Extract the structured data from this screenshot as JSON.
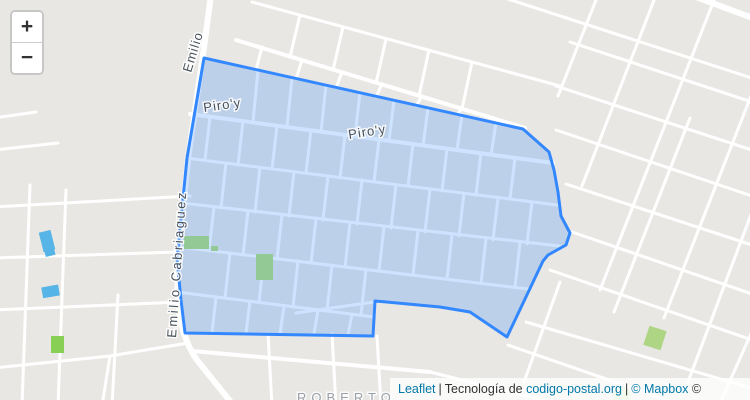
{
  "map": {
    "labels": {
      "street_top": "Emilio",
      "street_left": "Emilio Cabriaguez",
      "piroy_left": "Piro'y",
      "piroy_center": "Piro'y",
      "neighborhood": "ROBERTO"
    },
    "colors": {
      "land": "#e9e7e3",
      "road": "#ffffff",
      "polygon_stroke": "#3388ff",
      "polygon_fill_opacity": "0.24",
      "park_green_outside": "#87cf55",
      "park_green_inside": "#92c994",
      "building_blue": "#56b4e6"
    }
  },
  "controls": {
    "zoom_in": "+",
    "zoom_out": "−"
  },
  "attribution": {
    "leaflet": "Leaflet",
    "separator": "|",
    "prefix": "Tecnología de",
    "site_link": "codigo-postal.org",
    "mapbox_link": "© Mapbox",
    "suffix": "©"
  }
}
